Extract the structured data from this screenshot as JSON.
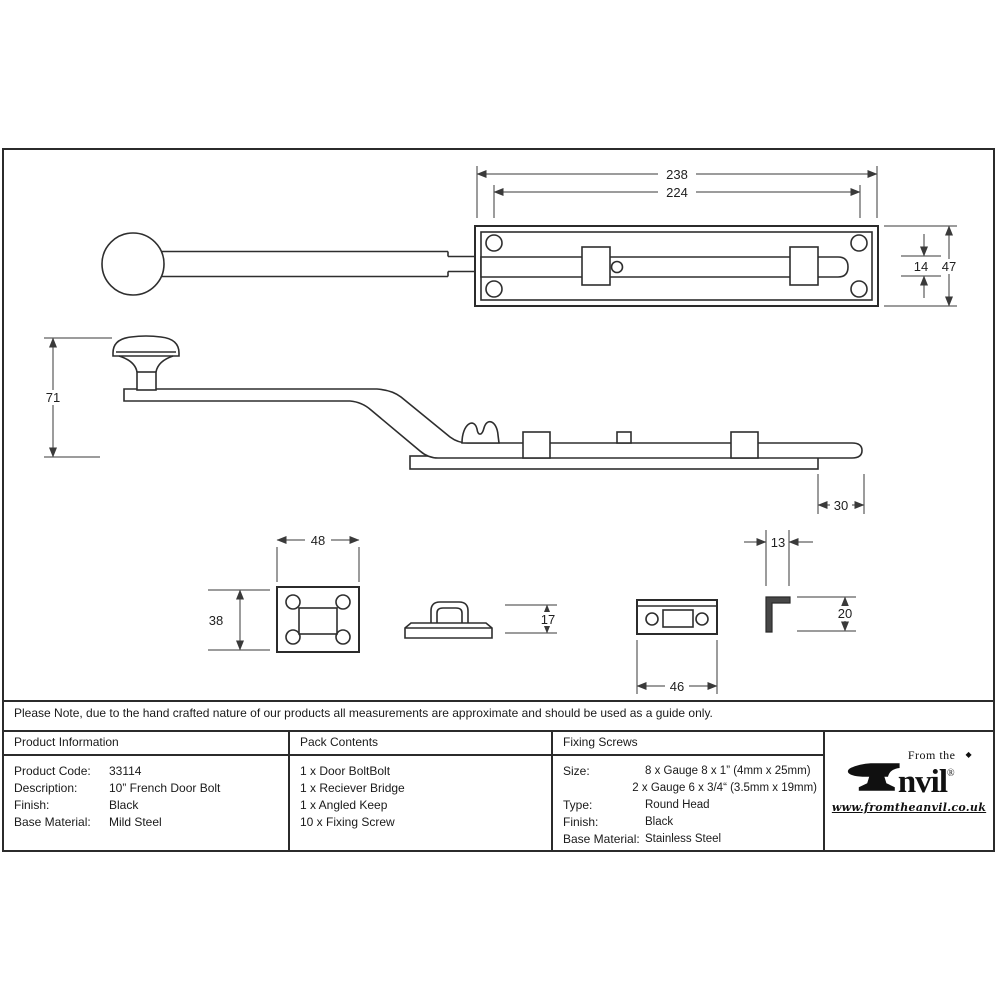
{
  "note": "Please Note, due to the hand crafted nature of our products all measurements are approximate and should be used as a guide only.",
  "drawing": {
    "dims": {
      "plate_length": "238",
      "fixing_centres": "224",
      "bolt_width": "14",
      "plate_width": "47",
      "knob_height": "71",
      "bolt_throw": "30",
      "bridge_plate_width": "48",
      "bridge_plate_height": "38",
      "bridge_height": "17",
      "keep_width": "46",
      "angled_keep_width": "13",
      "angled_keep_height": "20"
    }
  },
  "table": {
    "product_information": {
      "header": "Product Information",
      "rows": [
        {
          "label": "Product Code:",
          "value": "33114"
        },
        {
          "label": "Description:",
          "value": "10” French Door Bolt"
        },
        {
          "label": "Finish:",
          "value": "Black"
        },
        {
          "label": "Base Material:",
          "value": "Mild Steel"
        }
      ]
    },
    "pack_contents": {
      "header": "Pack Contents",
      "items": [
        "1 x Door BoltBolt",
        "1 x Reciever Bridge",
        "1 x Angled Keep",
        "10 x Fixing Screw"
      ]
    },
    "fixing_screws": {
      "header": "Fixing Screws",
      "rows": [
        {
          "label": "Size:",
          "value": "8 x Gauge 8 x 1” (4mm x 25mm)"
        },
        {
          "label": "",
          "value": "2 x Gauge 6 x 3/4“ (3.5mm x 19mm)"
        },
        {
          "label": "Type:",
          "value": "Round Head"
        },
        {
          "label": "Finish:",
          "value": "Black"
        },
        {
          "label": "Base Material:",
          "value": "Stainless Steel"
        }
      ]
    }
  },
  "logo": {
    "prefix": "From the",
    "diamond": "◆",
    "brand_rest": "nvil",
    "registered": "®",
    "url": "www.fromtheanvil.co.uk"
  },
  "colors": {
    "line": "#2b2b2b",
    "text": "#1a1a1a",
    "background": "#ffffff"
  }
}
